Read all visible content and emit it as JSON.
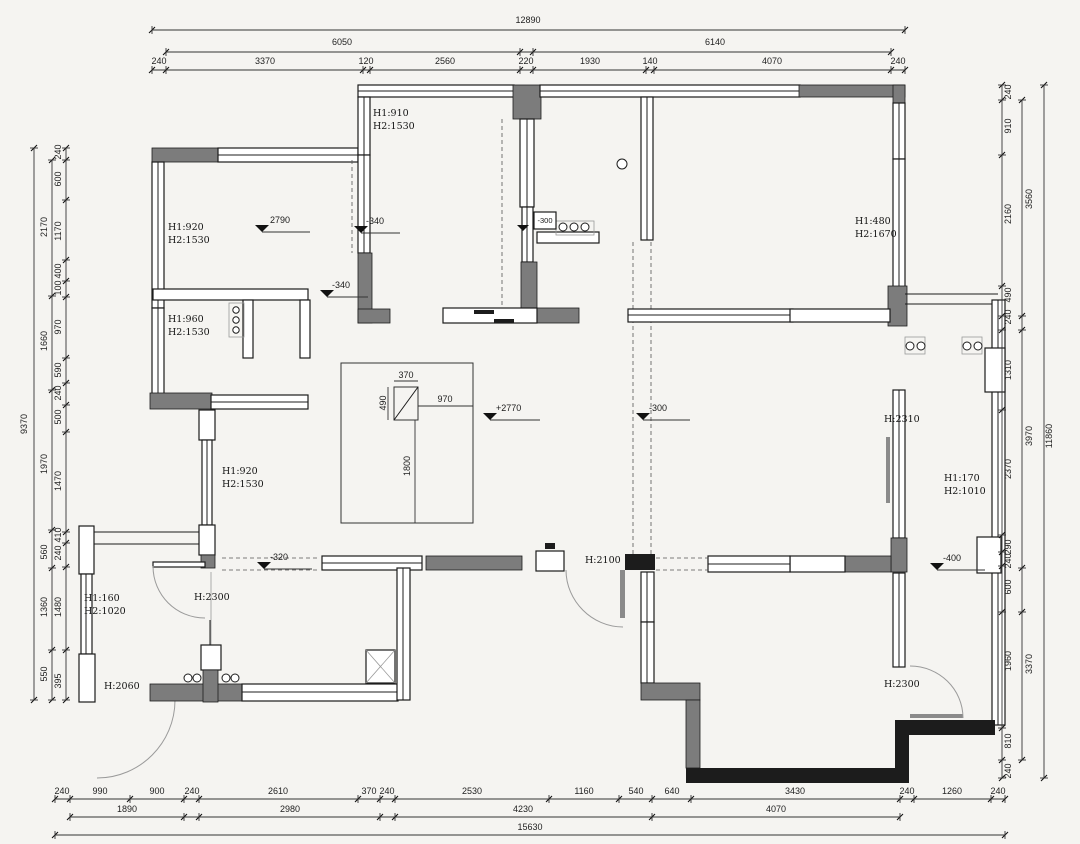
{
  "dims": {
    "top": {
      "total": "12890",
      "row2": [
        "6050",
        "6140"
      ],
      "row3": [
        "240",
        "3370",
        "120",
        "2560",
        "220",
        "1930",
        "140",
        "4070",
        "240"
      ]
    },
    "bottom": {
      "row1": [
        "240",
        "990",
        "900",
        "240",
        "2610",
        "370",
        "240",
        "2530",
        "1160",
        "540",
        "640",
        "3430",
        "240",
        "1260",
        "240"
      ],
      "row2": [
        "1890",
        "2980",
        "4230",
        "4070"
      ],
      "total": "15630"
    },
    "left": {
      "total": "9370",
      "col2": [
        "2170",
        "1660",
        "1970",
        "560",
        "1360",
        "550"
      ],
      "col3": [
        "240",
        "600",
        "1170",
        "400",
        "100",
        "970",
        "590",
        "240",
        "500",
        "1470",
        "410",
        "240",
        "1480",
        "395"
      ]
    },
    "right": {
      "total": "11860",
      "col2": [
        "3560",
        "3970",
        "3370"
      ],
      "col3": [
        "240",
        "910",
        "2160",
        "490",
        "240",
        "1310",
        "2370",
        "290",
        "240",
        "600",
        "1960",
        "810",
        "240"
      ]
    }
  },
  "heights": [
    {
      "l1": "H1:920",
      "l2": "H2:1530"
    },
    {
      "l1": "H1:910",
      "l2": "H2:1530"
    },
    {
      "l1": "H1:960",
      "l2": "H2:1530"
    },
    {
      "l1": "H1:480",
      "l2": "H2:1670"
    },
    {
      "l1": "H1:920",
      "l2": "H2:1530"
    },
    {
      "l1": "H1:160",
      "l2": "H2:1020"
    },
    {
      "l1": "H1:170",
      "l2": "H2:1010"
    }
  ],
  "height_singles": [
    "H:2300",
    "H:2100",
    "H:2310",
    "H:2060",
    "H:2300"
  ],
  "levels": {
    "lvl_2790": "2790",
    "lvl_340a": "-340",
    "lvl_340b": "-340",
    "lvl_300_box": "-300",
    "lvl_2770": "+2770",
    "lvl_300": "-300",
    "lvl_320": "-320",
    "lvl_400": "-400"
  },
  "detail": {
    "top": "370",
    "left": "490",
    "right": "970",
    "bottom": "1800"
  }
}
